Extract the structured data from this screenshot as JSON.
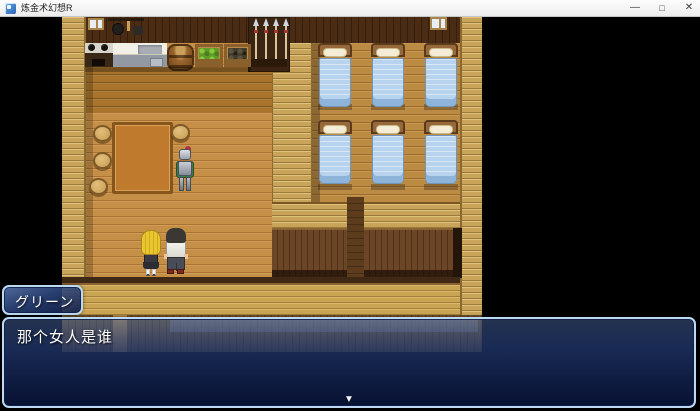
{
  "window": {
    "title": "炼金术幻想R",
    "controls": {
      "minimize": "—",
      "maximize": "□",
      "close": "✕"
    }
  },
  "dialogue": {
    "speaker_name": "グリーン",
    "message": "那个女人是谁",
    "continue_indicator": "▼"
  },
  "scene": {
    "description": "RPG Maker style wooden inn interior: kitchen with stove, counter, barrel and crates; dining table with stools and a knight NPC; dormitory with six blue beds; two characters (blonde girl, man in white shirt) standing in the hall",
    "colors": {
      "floor_wood": "#c68f47",
      "wall_gold": "#c8a45a",
      "wall_dark": "#4a2c15",
      "bed_blanket": "#b7d3ee",
      "dialog_border": "#bcd9f0",
      "dialog_fill": "#16295e",
      "titlebar_bg": "#f2f2f2"
    }
  }
}
